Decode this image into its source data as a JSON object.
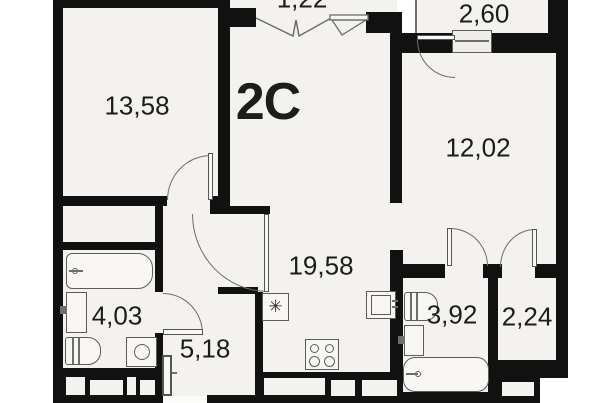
{
  "floor_plan": {
    "layout_code": "2C",
    "room_areas": {
      "bedroom_left": "13,58",
      "balcony_top": "1,22",
      "balcony_right": "2,60",
      "bedroom_right": "12,02",
      "kitchen_living": "19,58",
      "bathroom_left": "4,03",
      "hallway": "5,18",
      "bathroom_right": "3,92",
      "wc": "2,24"
    },
    "symbols": {
      "fridge": "✳"
    },
    "colors": {
      "wall": "#111111",
      "floor": "#f3f2ee",
      "outline": "#6e6e6e",
      "background": "#ffffff",
      "text": "#1c1c1c"
    }
  }
}
